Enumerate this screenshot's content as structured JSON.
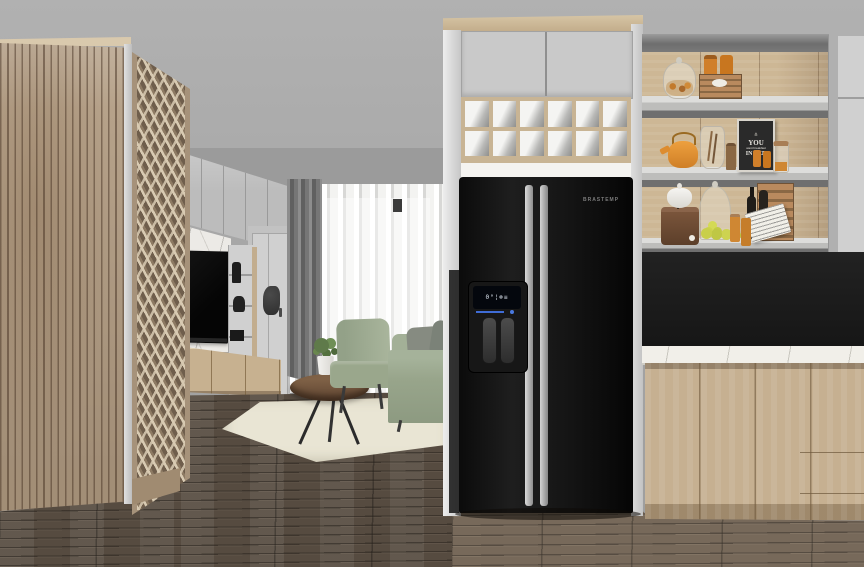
{
  "scene": {
    "type": "3D interior rendering",
    "style": "SketchUp-like architectural visualization",
    "rooms": [
      "living room",
      "kitchen"
    ]
  },
  "palette": {
    "wall": "#a8a8a8",
    "wood_light": "#c9b394",
    "wood_slat": "#b6a28a",
    "floor": "#5a5046",
    "fridge": "#141414",
    "backsplash": "#1b1b1b",
    "countertop": "#f1efe9",
    "sofa_green": "#9aa78d",
    "rug": "#e9e5d4",
    "curtain": "#757575",
    "accent_orange": "#d3882f"
  },
  "living_room": {
    "items": [
      "slatted wardrobe",
      "lattice panel",
      "wall cabinets",
      "marble tv wall",
      "tv",
      "floating media console",
      "decor shelf tower",
      "wall sculpture",
      "white door",
      "sheer curtains",
      "dark curtain",
      "green armchair",
      "green sofa with gray pillows",
      "round coffee table",
      "potted plant",
      "book",
      "area rug",
      "dark plank floor"
    ]
  },
  "fridge_column": {
    "upper_cabinet_doors": 2,
    "wine_rack_cells": 12,
    "fridge": {
      "brand_label": "BRASTEMP",
      "type": "black side-by-side refrigerator",
      "display_glyphs": "0°¦❄≡",
      "features": [
        "ice & water dispenser",
        "digital display",
        "twin vertical handles"
      ]
    }
  },
  "kitchen": {
    "chalkboard": {
      "icon": "⋔",
      "lines": [
        "YOU",
        "want breakfast",
        "IN BED"
      ]
    },
    "shelf_items": {
      "top": [
        "glass jar with candies",
        "wooden crate",
        "orange bottles"
      ],
      "middle": [
        "orange kettle",
        "glass hurricane vase",
        "pepper mill",
        "chalkboard print",
        "orange mugs",
        "glass canister"
      ],
      "bottom": [
        "white tureen",
        "coffee grinder",
        "glass cloche",
        "lemons",
        "orange jars",
        "wine bottles",
        "wooden crate",
        "printed wrap"
      ]
    },
    "surfaces": [
      "black backsplash",
      "white marble countertop",
      "oak base cabinets",
      "tall gray cabinet",
      "open oak shelving"
    ]
  }
}
